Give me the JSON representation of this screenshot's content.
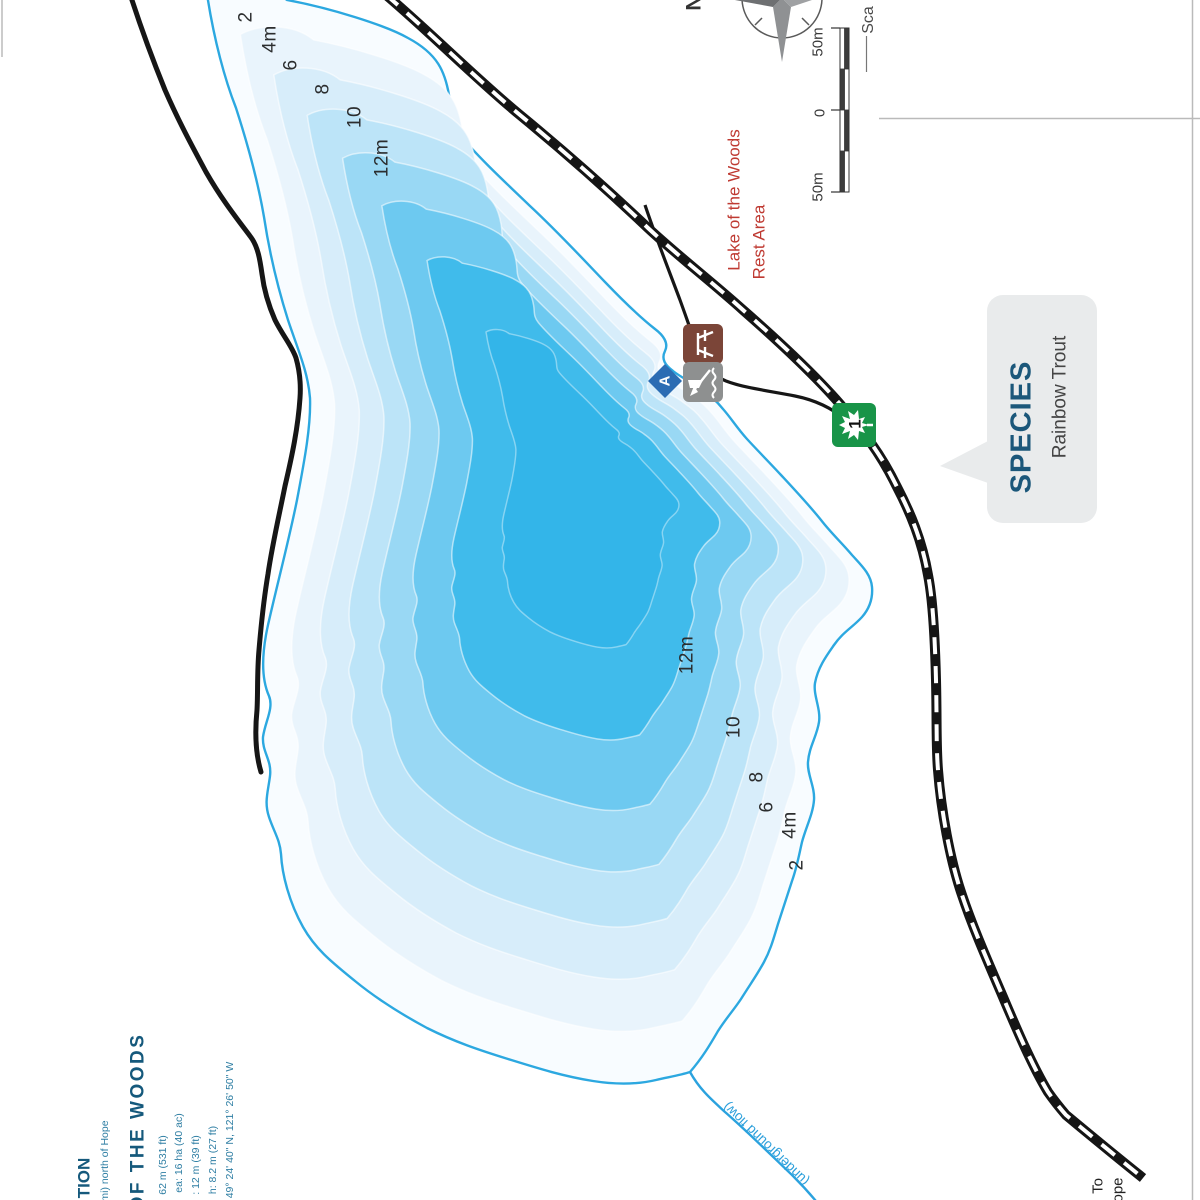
{
  "map_title_context": {
    "rest_area": {
      "line1": "Lake of the Woods",
      "line2": "Rest Area"
    },
    "stream_label": "(underground flow)",
    "to_label": {
      "line1": "To",
      "line2_fragment": "ope"
    }
  },
  "depth_contours_m": [
    2,
    4,
    6,
    8,
    10,
    12
  ],
  "depth_labels_north": [
    "2",
    "4m",
    "6",
    "8",
    "10",
    "12m"
  ],
  "depth_labels_south": [
    "12m",
    "10",
    "8",
    "6",
    "4m",
    "2"
  ],
  "compass": {
    "north": "N"
  },
  "scale_bar": {
    "top": "50m",
    "zero": "0",
    "bottom": "50m",
    "title_fragment": "Sca"
  },
  "highway_shield": {
    "number": "1"
  },
  "access_marker": {
    "letter": "A"
  },
  "species_callout": {
    "title": "SPECIES",
    "species_name": "Rainbow Trout"
  },
  "info_block": {
    "heading_fragment": "TION",
    "distance_fragment": "mi) north of Hope",
    "lake_title_fragment": "OF THE WOODS",
    "stat_fragments": [
      "62 m (531 ft)",
      "ea: 16 ha (40 ac)",
      ": 12 m (39 ft)",
      "h: 8.2 m (27 ft)",
      "49° 24' 40\" N, 121° 26' 50\" W"
    ]
  },
  "colors": {
    "shoreline": "#2ca8e0",
    "water_bands_shallow_to_deep": [
      "#f8fcff",
      "#e9f4fc",
      "#d7edfa",
      "#bce4f8",
      "#99d8f4",
      "#6dc9f0",
      "#40bbeb",
      "#33b5e9"
    ],
    "road": "#161616",
    "stream": "#2ba2de",
    "rest_area_text": "#bf3a32",
    "info_heading": "#15597c",
    "info_stats": "#2e7ea3",
    "species_title": "#1b577a",
    "fish_badge": "#f6921e",
    "shield_green": "#189448",
    "picnic_sign_brown": "#7b4538",
    "launch_sign_gray": "#8e9090",
    "access_blue": "#2b6cb3",
    "callout_bg": "#e9ebec",
    "page_border": "#bababa"
  }
}
